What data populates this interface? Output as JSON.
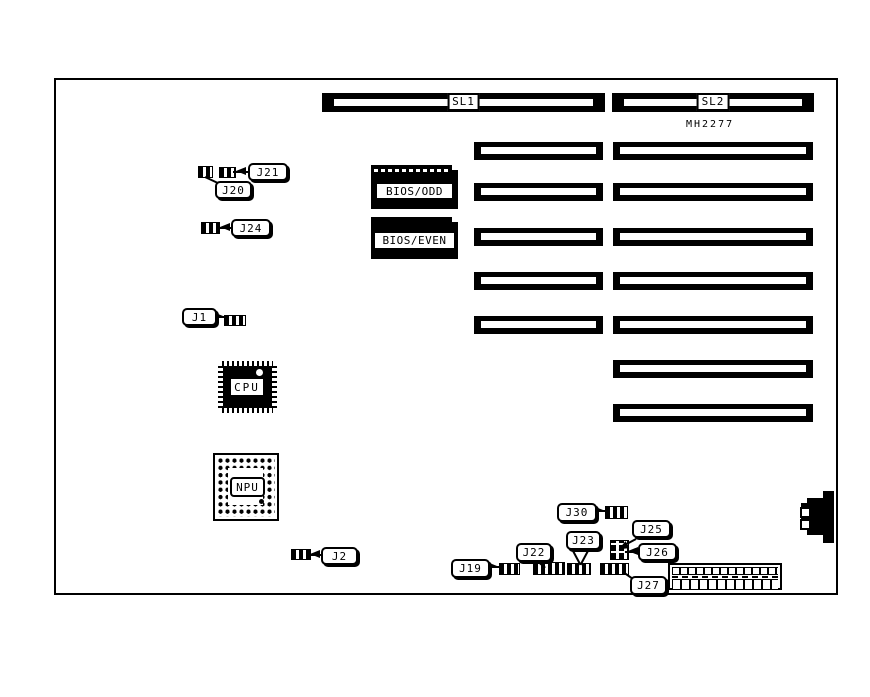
{
  "diagram": {
    "part_number": "MH2277",
    "slots": {
      "sl1": "SL1",
      "sl2": "SL2"
    },
    "chips": {
      "bios_odd": "BIOS/ODD",
      "bios_even": "BIOS/EVEN",
      "cpu": "CPU",
      "npu": "NPU"
    },
    "jumpers": {
      "j1": "J1",
      "j2": "J2",
      "j19": "J19",
      "j20": "J20",
      "j21": "J21",
      "j22": "J22",
      "j23": "J23",
      "j24": "J24",
      "j25": "J25",
      "j26": "J26",
      "j27": "J27",
      "j30": "J30"
    },
    "colors": {
      "ink": "#000000",
      "paper": "#ffffff"
    }
  }
}
